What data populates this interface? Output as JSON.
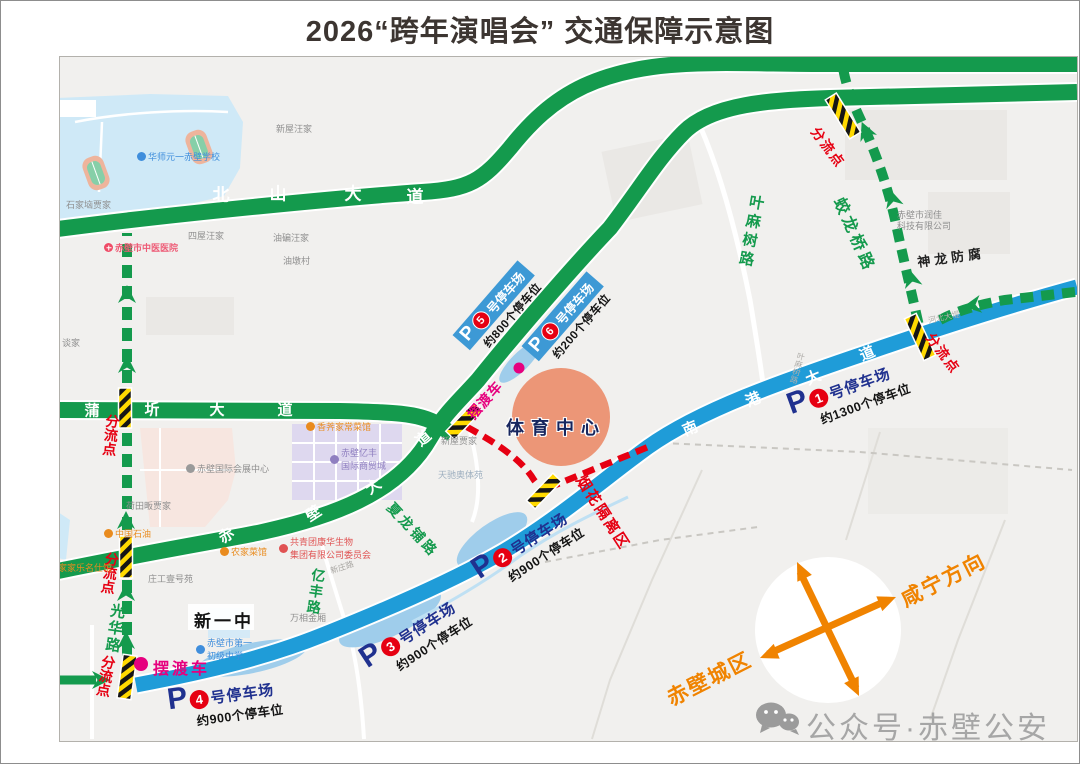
{
  "title": "2026“跨年演唱会” 交通保障示意图",
  "roads": {
    "beishan": {
      "name": "北山大道",
      "chars": [
        "北",
        "山",
        "大",
        "道"
      ]
    },
    "puqi": {
      "name": "蒲圻大道",
      "chars": [
        "蒲",
        "圻",
        "大",
        "道"
      ]
    },
    "chibi": {
      "name": "赤壁大道",
      "chars": [
        "赤",
        "壁",
        "大",
        "道"
      ]
    },
    "nangang": {
      "name": "南港大道",
      "chars": [
        "南",
        "港",
        "大",
        "道"
      ]
    },
    "yemashu": "叶麻树路",
    "jiaolongqiao": "蛟龙桥路",
    "xialongpu": "夏龙铺路",
    "yifeng": "亿丰路",
    "guanghua": "光华路",
    "shenlong": "神龙防腐",
    "xinzhuang": "新庄路",
    "yemashu_small": "叶麻树路",
    "hebei": "河北大堤"
  },
  "markers": {
    "fenliudian": "分流点",
    "baiduche": "摆渡车",
    "yanhua": "烟花隔离区",
    "tiyu": "体育中心",
    "xinyizhong": "新一中"
  },
  "parking": {
    "p1": {
      "p": "P",
      "num": "1",
      "name": "号停车场",
      "capacity": "约1300个停车位"
    },
    "p2": {
      "p": "P",
      "num": "2",
      "name": "号停车场",
      "capacity": "约900个停车位"
    },
    "p3": {
      "p": "P",
      "num": "3",
      "name": "号停车场",
      "capacity": "约900个停车位"
    },
    "p4": {
      "p": "P",
      "num": "4",
      "name": "号停车场",
      "capacity": "约900个停车位"
    },
    "p5": {
      "p": "P",
      "num": "5",
      "name": "号停车场",
      "capacity": "约800个停车位"
    },
    "p6": {
      "p": "P",
      "num": "6",
      "name": "号停车场",
      "capacity": "约200个停车位"
    }
  },
  "pois": {
    "shijianao": "石家垴贾家",
    "xinwu_wang": "新屋汪家",
    "siwu_wang": "四屋汪家",
    "youbian_wang": "油碥汪家",
    "youdun": "油墩村",
    "tanjia": "谈家",
    "hetianfan": "荷田畈贾家",
    "xinwu_jia": "新屋贾家",
    "tianchi": "天驰奥体苑",
    "wanxiang": "万相金厢",
    "zhuanggong": "庄工壹号苑",
    "school1": "华师元一赤壁学校",
    "hospital": "赤壁市中医医院",
    "school2_l1": "赤壁市第一",
    "school2_l2": "初级中学",
    "exhibition": "赤壁国际会展中心",
    "restaurant1": "香荠家常菜馆",
    "mall_l1": "赤壁亿丰",
    "mall_l2": "国际商贸城",
    "youth_l1": "共青团康华生物",
    "youth_l2": "集团有限公司委员会",
    "restaurant2": "农家菜馆",
    "petro": "中国石油",
    "jiajiale": "家家乐名仕馆",
    "runjia_l1": "赤壁市润佳",
    "runjia_l2": "科技有限公司"
  },
  "compass": {
    "xianning": "咸宁方向",
    "chibicity": "赤壁城区"
  },
  "watermark": "公众号·赤壁公安",
  "colors": {
    "road_green": "#149a4d",
    "road_blue": "#1f9cd8",
    "route_red": "#e60012",
    "magenta": "#e6007e",
    "orange": "#f08300",
    "navy": "#20318f"
  }
}
